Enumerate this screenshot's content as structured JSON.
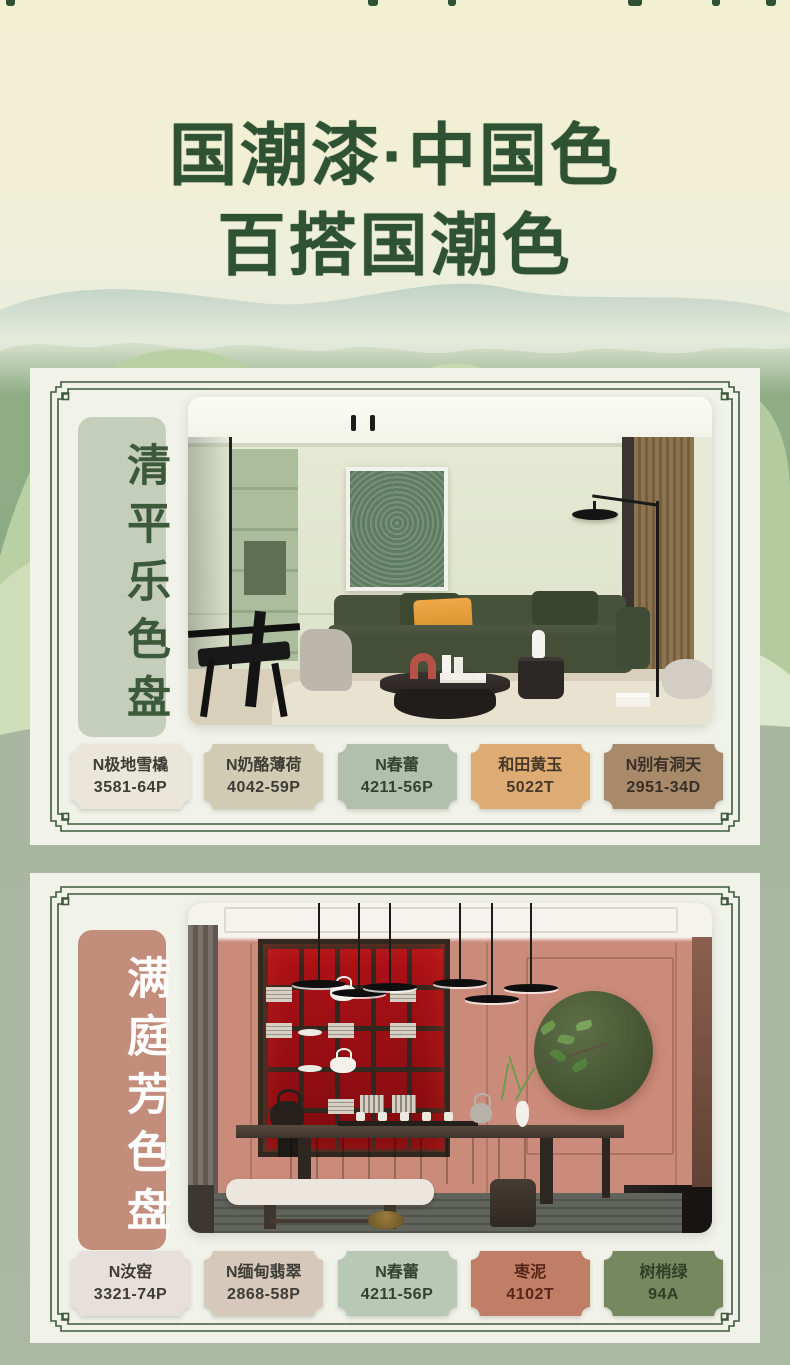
{
  "page": {
    "title_line1": "国潮漆·中国色",
    "title_line2": "百搭国潮色"
  },
  "colors": {
    "title_green": "#2f5233",
    "frame_green": "#3e5a3d",
    "page_top": "#f2f0d4",
    "page_bottom": "#a9b7a1",
    "card_paper": "#f1f2e9"
  },
  "palettes": [
    {
      "label": "清平乐色盘",
      "label_bg": "#c5cebb",
      "label_text": "#3c5a39",
      "photo_alt": "现代客厅：灰绿墙面、绿色装饰画、墨绿布艺沙发、橙色抱枕、黑色落地灯",
      "swatches": [
        {
          "name": "N极地雪橇",
          "code": "3581-64P",
          "fill": "#eae7da",
          "text": "#3d3d35"
        },
        {
          "name": "N奶酪薄荷",
          "code": "4042-59P",
          "fill": "#d0cbb3",
          "text": "#3d3d35"
        },
        {
          "name": "N春蕾",
          "code": "4211-56P",
          "fill": "#b2bfad",
          "text": "#33422f",
          "stroke": "#42603f"
        },
        {
          "name": "和田黄玉",
          "code": "5022T",
          "fill": "#ddab73",
          "text": "#46382a"
        },
        {
          "name": "N别有洞天",
          "code": "2951-34D",
          "fill": "#a8896a",
          "text": "#382f27"
        }
      ]
    },
    {
      "label": "满庭芳色盘",
      "label_bg": "#c38d7b",
      "label_text": "#ffffff",
      "photo_alt": "中式茶室：陶粉色墙面、红色博古架、墨绿圆形挂饰、深色茶台与白色长凳",
      "swatches": [
        {
          "name": "N汝窑",
          "code": "3321-74P",
          "fill": "#e7dfdb",
          "text": "#3d3d35"
        },
        {
          "name": "N缅甸翡翠",
          "code": "2868-58P",
          "fill": "#d6c8ba",
          "text": "#3d3d35"
        },
        {
          "name": "N春蕾",
          "code": "4211-56P",
          "fill": "#b9c8b5",
          "text": "#33422f"
        },
        {
          "name": "枣泥",
          "code": "4102T",
          "fill": "#c17e66",
          "text": "#5a2518",
          "stroke": "#80301f"
        },
        {
          "name": "树梢绿",
          "code": "94A",
          "fill": "#75885f",
          "text": "#323f28"
        }
      ]
    }
  ]
}
